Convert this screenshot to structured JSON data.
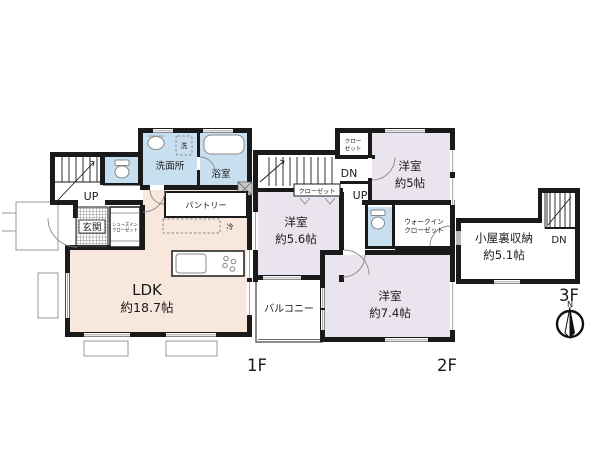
{
  "palette": {
    "wall_color": "#1a1a1a",
    "ldk_fill": "#f8e7dc",
    "wet_area_fill": "#c8dff0",
    "bedroom_fill": "#eae4ee"
  },
  "floor1": {
    "label": "1F",
    "ldk": {
      "name": "LDK",
      "size": "約18.7帖"
    },
    "washroom": "洗面所",
    "bath": "浴室",
    "washer": "洗",
    "pantry": "パントリー",
    "genkan": "玄関",
    "shoe_closet": {
      "line1": "シューズイン",
      "line2": "クローゼット"
    },
    "fridge": "冷",
    "stairs_up": "UP"
  },
  "floor2": {
    "label": "2F",
    "bedroom_a": {
      "name": "洋室",
      "size": "約5.6帖"
    },
    "bedroom_b": {
      "name": "洋室",
      "size": "約5帖"
    },
    "bedroom_c": {
      "name": "洋室",
      "size": "約7.4帖"
    },
    "balcony": "バルコニー",
    "closet": "クローゼット",
    "closet_small": {
      "line1": "クロー",
      "line2": "ゼット"
    },
    "walk_in_closet": {
      "line1": "ウォークイン",
      "line2": "クローゼット"
    },
    "stairs_dn": "DN",
    "stairs_up": "UP"
  },
  "floor3": {
    "label": "3F",
    "attic": {
      "name": "小屋裏収納",
      "size": "約5.1帖"
    },
    "stairs_dn": "DN"
  },
  "compass": {
    "north": "N"
  }
}
